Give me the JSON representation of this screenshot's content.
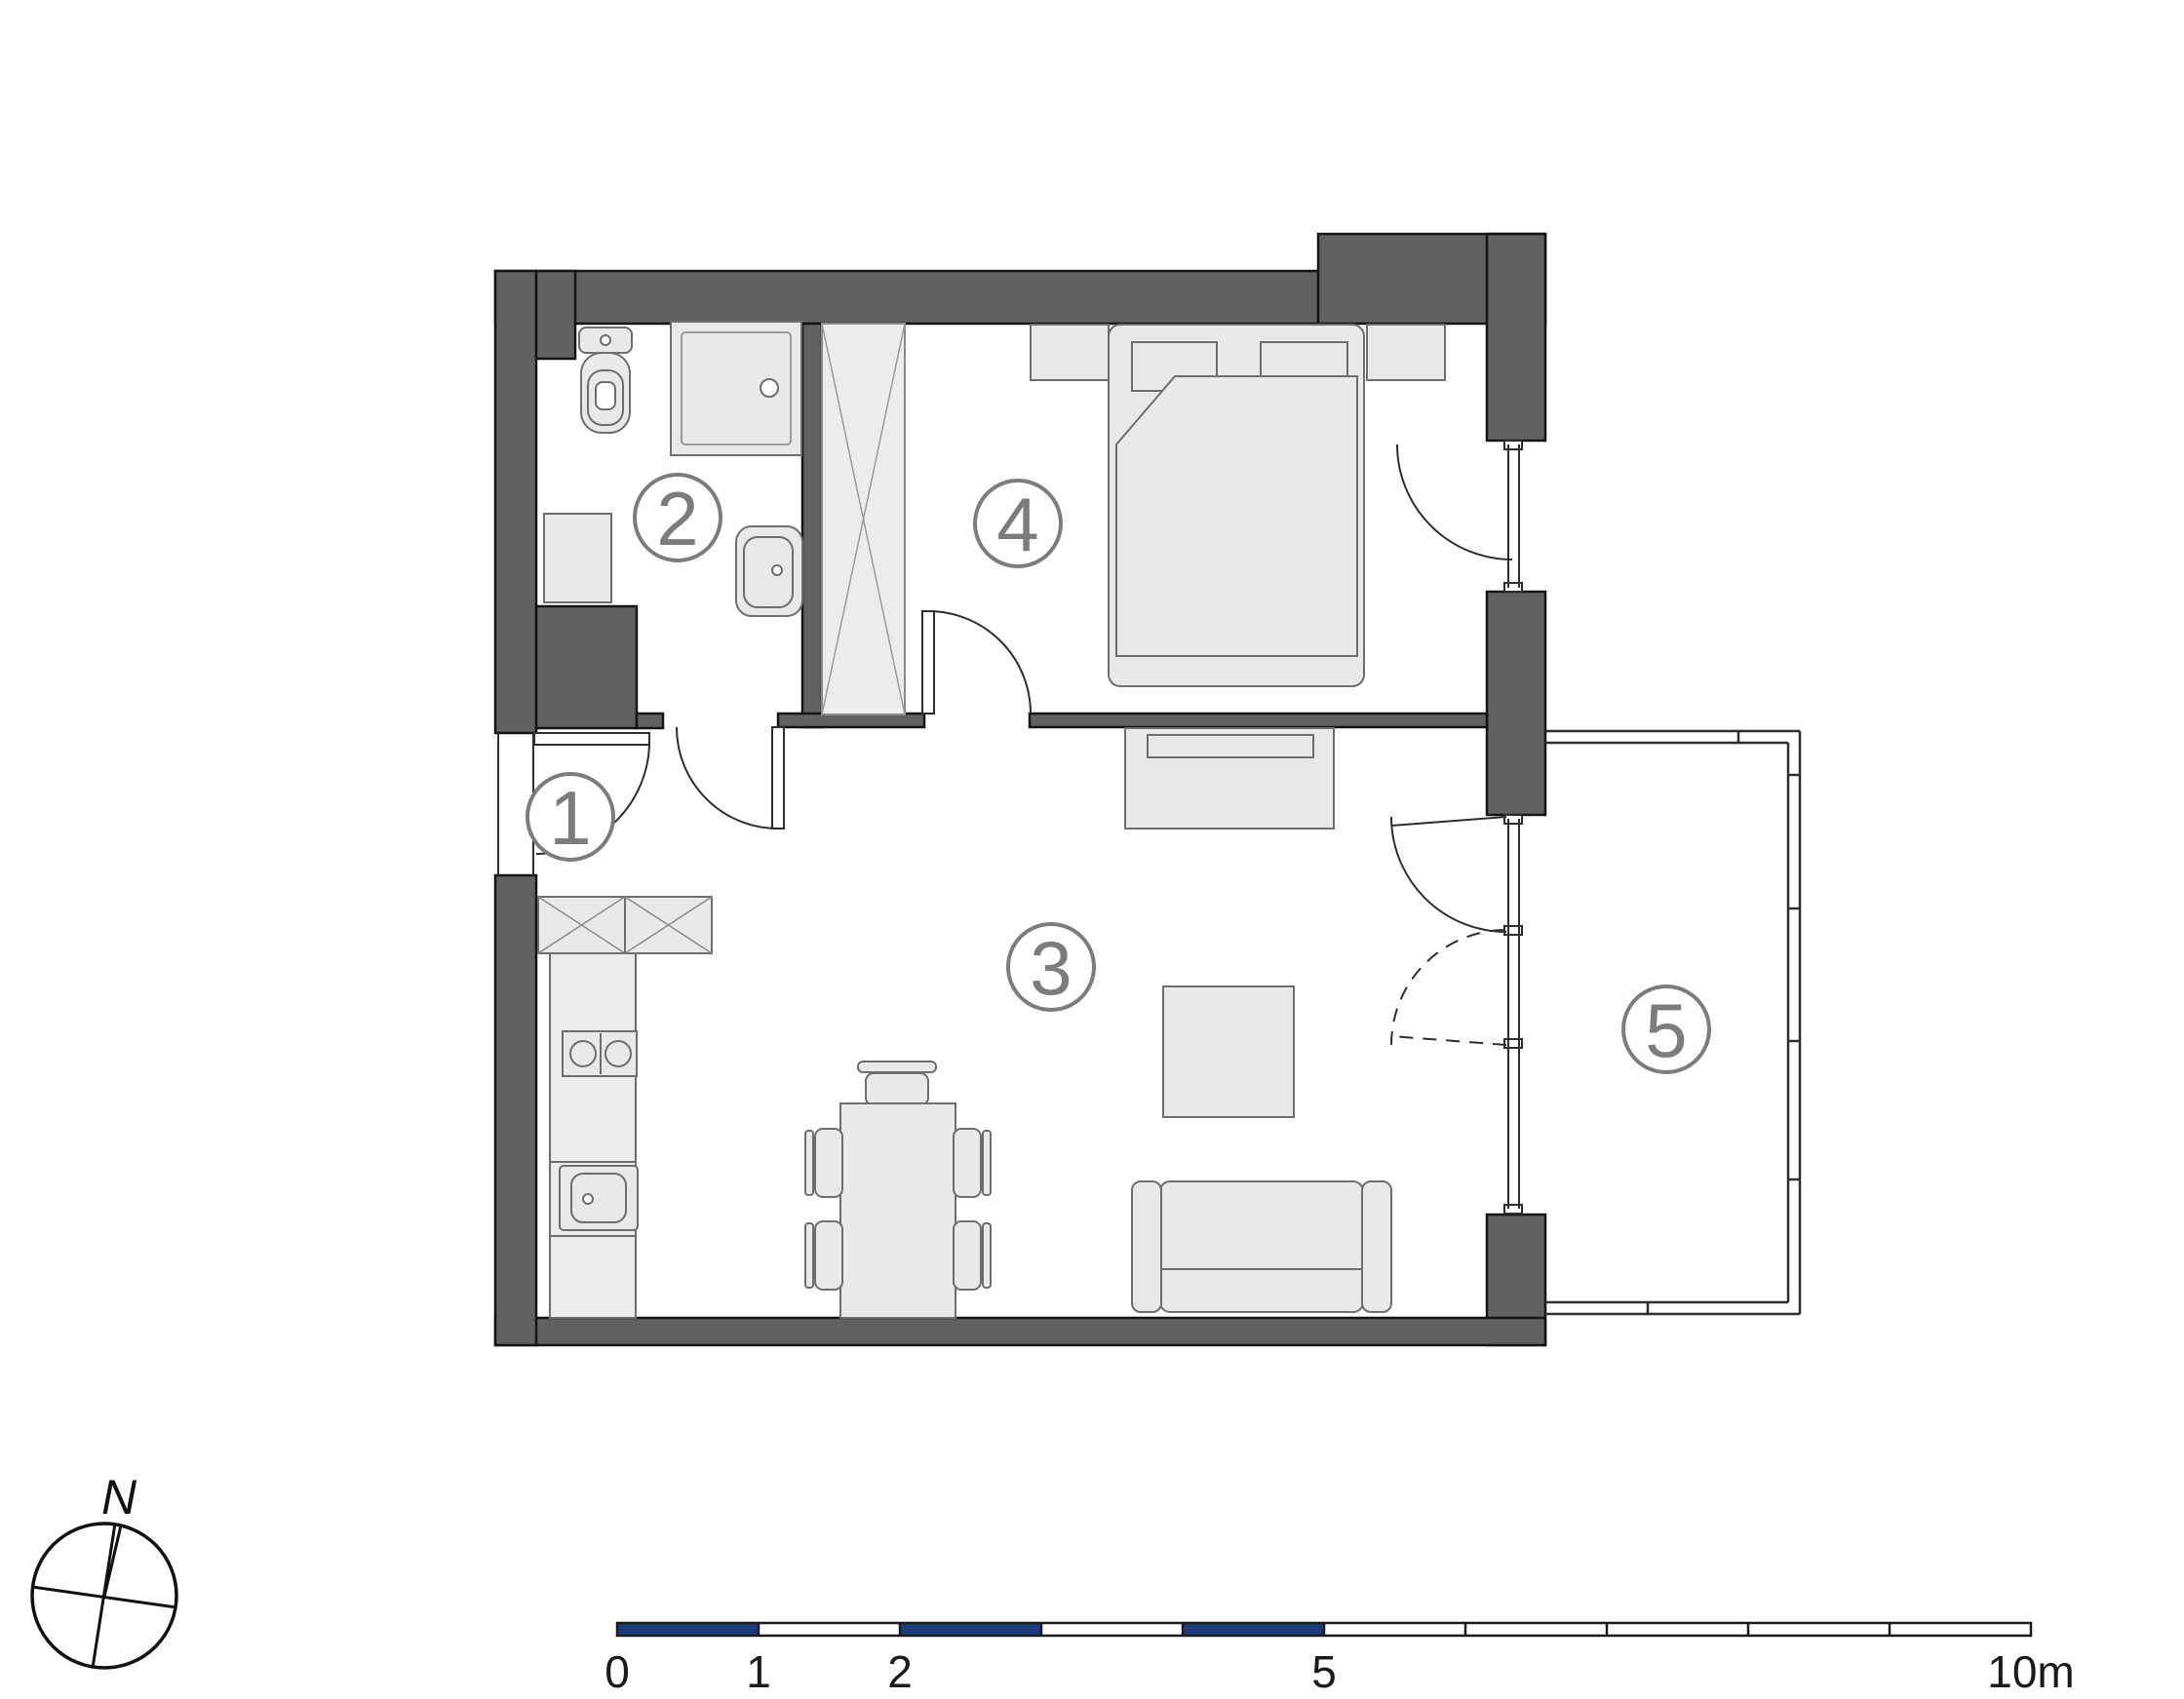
{
  "plan": {
    "type": "apartment-floor-plan",
    "rooms": {
      "r1": {
        "label": "1",
        "name": "entrance-hall"
      },
      "r2": {
        "label": "2",
        "name": "bathroom"
      },
      "r3": {
        "label": "3",
        "name": "living-room-with-kitchen"
      },
      "r4": {
        "label": "4",
        "name": "bedroom"
      },
      "r5": {
        "label": "5",
        "name": "balcony"
      }
    }
  },
  "compass": {
    "north": "N"
  },
  "scalebar": {
    "labels": {
      "m0": "0",
      "m1": "1",
      "m2": "2",
      "m5": "5",
      "m10": "10m"
    },
    "meters_total": 10,
    "blue_segments_m": [
      [
        0,
        1
      ],
      [
        2,
        3
      ],
      [
        4,
        5
      ]
    ]
  },
  "colors": {
    "wall": "#606163",
    "furniture": "#E9E9E9",
    "furniture_light": "#ECECEC",
    "scale_blue": "#1E3C7D",
    "line": "#2E2E2E",
    "label_gray": "#7C7C7C"
  }
}
